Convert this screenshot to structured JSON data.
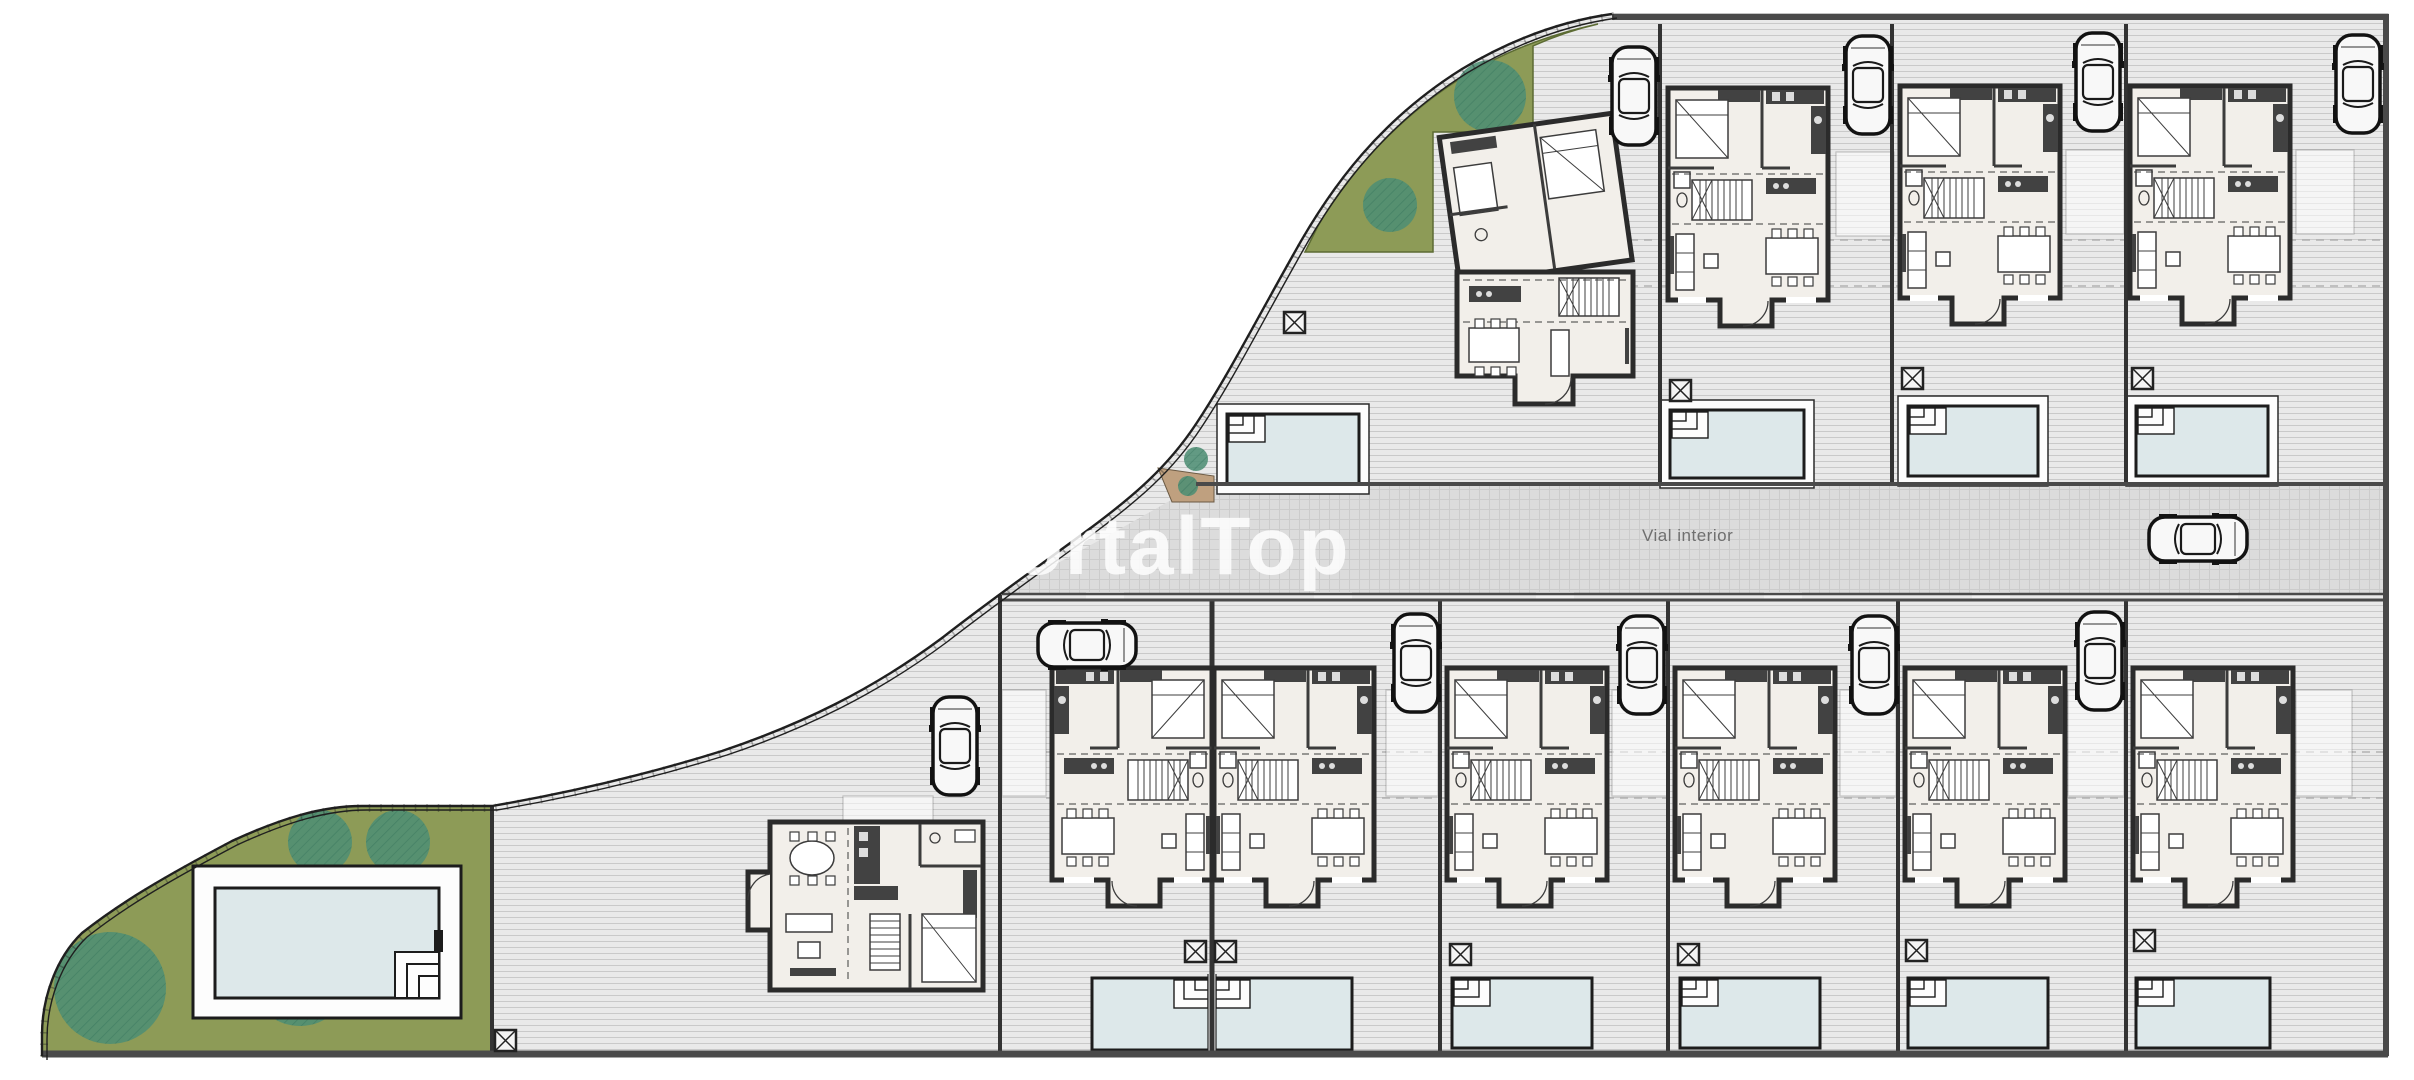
{
  "meta": {
    "title": "Residential development site plan",
    "plan_type": "architectural-site-plan",
    "dwelling_count": 11,
    "pool_count": 10,
    "car_count": 11
  },
  "watermark": {
    "text": "PortalTop"
  },
  "road": {
    "label": "Vial interior"
  },
  "colors": {
    "terrain_bg": "#e9e9e9",
    "terrain_line": "#c9c9c9",
    "road_bg": "#dcdcdc",
    "road_line": "#c2c2c2",
    "green": "#8d9b57",
    "tree": "#4f8e74",
    "tree_hatch": "#2f6e58",
    "pool_water": "#dde8ea",
    "deck": "#fdfdfd",
    "wall": "#2b2b2b",
    "floor": "#f2efea",
    "furniture_dark": "#424242",
    "furniture_line": "#3c3c3c",
    "fence": "#333333",
    "boundary": "#1f1f1f",
    "label": "#6f6f6f",
    "watermark": "#ffffff",
    "tan": "#bfa07f",
    "edge_thick": "#4a4a4a"
  },
  "site": {
    "terrain_path": "M1612,14 L2388,14 L2388,1056 L42,1056 L42,1035 C42,998 56,958 82,933 C120,903 162,878 232,841 C282,818 322,806 362,806 L492,806 C562,794 642,776 722,751 C802,724 872,690 942,638 C992,599 1042,564 1092,527 C1132,497 1167,468 1196,424 C1226,379 1252,328 1292,257 C1332,184 1382,119 1462,69 C1512,39 1562,21 1612,14 Z",
    "boundary_path": "M1612,14 C1562,21 1512,39 1462,69 C1382,119 1332,184 1292,257 C1252,328 1226,379 1196,424 C1167,468 1132,497 1092,527 C1042,564 992,599 942,638 C872,690 802,724 722,751 C642,776 562,794 492,806 L362,806 C322,806 282,818 232,841 C162,878 120,903 82,933 C56,958 42,998 42,1035 L42,1056",
    "road_path": "M1196,486 L2386,486 L2386,593 L1002,593 C1072,556 1136,520 1196,486 Z",
    "green_nw_path": "M1598,24 C1548,35 1502,52 1458,80 C1402,116 1350,170 1318,226 L1305,252 L1433,252 L1433,132 L1533,132 L1533,46 C1555,36 1576,29 1598,24 Z",
    "green_sw_path": "M42,1035 C42,998 56,958 82,933 C120,903 162,878 232,841 C282,818 322,806 362,806 L492,806 L492,1056 L42,1056 Z",
    "tan_patch_path": "M1158,468 L1214,476 L1214,502 L1172,502 Z",
    "trees": [
      {
        "x": 320,
        "y": 842,
        "r": 32
      },
      {
        "x": 398,
        "y": 842,
        "r": 32
      },
      {
        "x": 110,
        "y": 988,
        "r": 56
      },
      {
        "x": 300,
        "y": 976,
        "r": 50
      },
      {
        "x": 1490,
        "y": 96,
        "r": 36
      },
      {
        "x": 1390,
        "y": 205,
        "r": 27
      },
      {
        "x": 1196,
        "y": 459,
        "r": 12
      },
      {
        "x": 1188,
        "y": 486,
        "r": 10
      }
    ],
    "houses": [
      {
        "id": "villa-1",
        "type": "villaA",
        "x": 1457,
        "y": 122
      },
      {
        "id": "villa-2",
        "type": "std",
        "x": 1668,
        "y": 88
      },
      {
        "id": "villa-3",
        "type": "std",
        "x": 1900,
        "y": 86
      },
      {
        "id": "villa-4",
        "type": "std",
        "x": 2130,
        "y": 86
      },
      {
        "id": "villa-5",
        "type": "villaB",
        "x": 770,
        "y": 822
      },
      {
        "id": "villa-6",
        "type": "stdM",
        "x": 1052,
        "y": 668
      },
      {
        "id": "villa-7",
        "type": "std",
        "x": 1214,
        "y": 668
      },
      {
        "id": "villa-8",
        "type": "std",
        "x": 1447,
        "y": 668
      },
      {
        "id": "villa-9",
        "type": "std",
        "x": 1675,
        "y": 668
      },
      {
        "id": "villa-10",
        "type": "std",
        "x": 1905,
        "y": 668
      },
      {
        "id": "villa-11",
        "type": "std",
        "x": 2133,
        "y": 668
      }
    ],
    "pools": [
      {
        "id": "pool-top-1",
        "x": 1227,
        "y": 414,
        "w": 132,
        "h": 70,
        "steps": "nw",
        "deck": true
      },
      {
        "id": "pool-top-2",
        "x": 1670,
        "y": 410,
        "w": 134,
        "h": 68,
        "steps": "nw",
        "deck": true
      },
      {
        "id": "pool-top-3",
        "x": 1908,
        "y": 406,
        "w": 130,
        "h": 70,
        "steps": "nw",
        "deck": true
      },
      {
        "id": "pool-top-4",
        "x": 2136,
        "y": 406,
        "w": 132,
        "h": 70,
        "steps": "nw",
        "deck": true
      },
      {
        "id": "pool-pair",
        "x": 1092,
        "y": 978,
        "w": 260,
        "h": 72,
        "steps": "center",
        "divider": 1212
      },
      {
        "id": "pool-b-1",
        "x": 1452,
        "y": 978,
        "w": 140,
        "h": 70,
        "steps": "nw"
      },
      {
        "id": "pool-b-2",
        "x": 1680,
        "y": 978,
        "w": 140,
        "h": 70,
        "steps": "nw"
      },
      {
        "id": "pool-b-3",
        "x": 1908,
        "y": 978,
        "w": 140,
        "h": 70,
        "steps": "nw"
      },
      {
        "id": "pool-b-4",
        "x": 2136,
        "y": 978,
        "w": 134,
        "h": 70,
        "steps": "nw"
      }
    ],
    "communal_pool": {
      "deck": [
        193,
        866,
        268,
        152
      ],
      "water": [
        215,
        888,
        224,
        110
      ],
      "steps": "se",
      "ladder": true
    },
    "cars": [
      {
        "x": 1612,
        "y": 47,
        "rot": 0
      },
      {
        "x": 1846,
        "y": 36,
        "rot": 0
      },
      {
        "x": 2076,
        "y": 33,
        "rot": 0
      },
      {
        "x": 2336,
        "y": 35,
        "rot": 0
      },
      {
        "x": 1064,
        "y": 595,
        "rot": 90
      },
      {
        "x": 1394,
        "y": 614,
        "rot": 0
      },
      {
        "x": 933,
        "y": 697,
        "rot": 0
      },
      {
        "x": 1620,
        "y": 616,
        "rot": 0
      },
      {
        "x": 1852,
        "y": 616,
        "rot": 0
      },
      {
        "x": 2078,
        "y": 612,
        "rot": 0
      },
      {
        "x": 2175,
        "y": 489,
        "rot": 90
      }
    ],
    "k_boxes": [
      [
        1284,
        312
      ],
      [
        1670,
        380
      ],
      [
        1902,
        368
      ],
      [
        2132,
        368
      ],
      [
        495,
        1030
      ],
      [
        1185,
        941
      ],
      [
        1215,
        941
      ],
      [
        1450,
        944
      ],
      [
        1678,
        944
      ],
      [
        1906,
        940
      ],
      [
        2134,
        930
      ]
    ],
    "fences_v": [
      [
        1660,
        24,
        482
      ],
      [
        1892,
        24,
        482
      ],
      [
        2126,
        24,
        482
      ],
      [
        1000,
        595,
        1054
      ],
      [
        1440,
        600,
        1054
      ],
      [
        1668,
        600,
        1054
      ],
      [
        1898,
        600,
        1054
      ],
      [
        2126,
        600,
        1054
      ],
      [
        492,
        806,
        1054
      ]
    ],
    "divider_v": [
      1212,
      600,
      1054
    ],
    "edges": [
      {
        "x1": 1612,
        "y1": 17,
        "x2": 2388,
        "y2": 17,
        "w": 6
      },
      {
        "x1": 2386,
        "y1": 14,
        "x2": 2386,
        "y2": 1056,
        "w": 6
      },
      {
        "x1": 42,
        "y1": 1054,
        "x2": 2388,
        "y2": 1054,
        "w": 7
      },
      {
        "x1": 1196,
        "y1": 484,
        "x2": 2386,
        "y2": 484,
        "w": 4
      },
      {
        "x1": 1002,
        "y1": 594,
        "x2": 2386,
        "y2": 594,
        "w": 2.5
      },
      {
        "x1": 1002,
        "y1": 600,
        "x2": 2386,
        "y2": 600,
        "w": 3
      }
    ],
    "guides": [
      [
        1462,
        240,
        2388,
        240
      ],
      [
        1462,
        286,
        2388,
        286
      ],
      [
        1046,
        752,
        2384,
        752
      ],
      [
        1046,
        798,
        2384,
        798
      ]
    ],
    "terraces": [
      [
        1836,
        152,
        58,
        84
      ],
      [
        2066,
        150,
        58,
        84
      ],
      [
        2296,
        150,
        58,
        84
      ],
      [
        1002,
        690,
        44,
        106
      ],
      [
        1386,
        690,
        52,
        106
      ],
      [
        1612,
        690,
        56,
        106
      ],
      [
        1840,
        690,
        56,
        106
      ],
      [
        2068,
        690,
        56,
        106
      ],
      [
        2296,
        690,
        56,
        106
      ],
      [
        843,
        796,
        90,
        26
      ]
    ],
    "driveway_gaps": [
      [
        1086,
        592,
        38,
        9
      ],
      [
        1314,
        592,
        38,
        9
      ],
      [
        1536,
        592,
        38,
        9
      ],
      [
        1764,
        592,
        38,
        9
      ],
      [
        1972,
        592,
        38,
        9
      ],
      [
        2200,
        592,
        38,
        9
      ]
    ],
    "label_pos": {
      "x": 1642,
      "y": 541
    },
    "watermark_pos": {
      "x": 956,
      "y": 574
    }
  }
}
